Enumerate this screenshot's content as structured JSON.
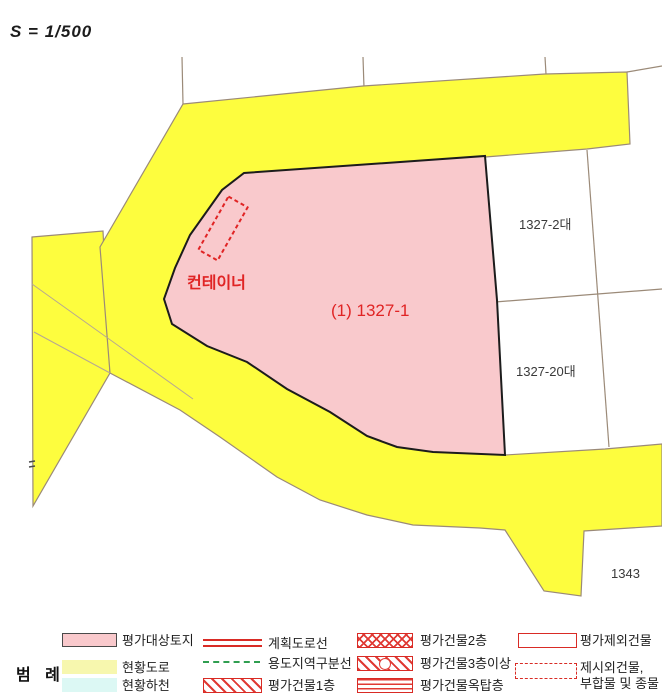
{
  "scale_label": "S = 1/500",
  "map": {
    "labels": {
      "container": "컨테이너",
      "subject_parcel": "(1) 1327-1",
      "parcel_2": "1327-2대",
      "parcel_20": "1327-20대",
      "parcel_1343": "1343"
    }
  },
  "legend": {
    "title": "범 례",
    "items": [
      {
        "id": "subject-land",
        "label": "평가대상토지"
      },
      {
        "id": "existing-road",
        "label": "현황도로"
      },
      {
        "id": "existing-river",
        "label": "현황하천"
      },
      {
        "id": "planned-road-line",
        "label": "계획도로선"
      },
      {
        "id": "zoning-line",
        "label": "용도지역구분선"
      },
      {
        "id": "building-1f",
        "label": "평가건물1층"
      },
      {
        "id": "building-2f",
        "label": "평가건물2층"
      },
      {
        "id": "building-3f-up",
        "label": "평가건물3층이상"
      },
      {
        "id": "building-rooftop",
        "label": "평가건물옥탑층"
      },
      {
        "id": "excluded-building",
        "label": "평가제외건물"
      },
      {
        "id": "unlisted-building",
        "label_line1": "제시외건물,",
        "label_line2": "부합물 및 종물"
      }
    ]
  },
  "colors": {
    "road_yellow": "#fdfd3e",
    "legend_road_yellow": "#f7f7ae",
    "subject_pink": "#f9c9cc",
    "river_cyan": "#dcf8f4",
    "accent_red": "#d92b25",
    "zone_green": "#2f9e50",
    "parcel_line_brown": "#9b8a78",
    "parcel_border_black": "#1c1c1c"
  }
}
